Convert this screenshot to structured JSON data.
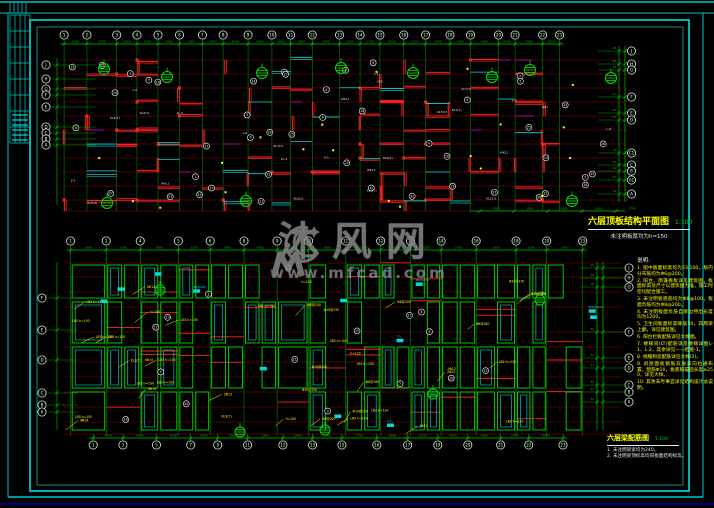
{
  "watermark": {
    "name": "沐风网",
    "url": "www.mfcad.com",
    "logo_icon": "crescent-m-logo",
    "color": "#8f8f8f"
  },
  "top_plan": {
    "title": "六层顶板结构平面图",
    "scale": "1:100",
    "subtitle": "未注明板厚均为h=150",
    "axes_top": [
      "1",
      "2",
      "3",
      "4",
      "5",
      "6",
      "7",
      "8",
      "9",
      "10",
      "11",
      "12",
      "13",
      "14",
      "15",
      "16",
      "17",
      "18",
      "19",
      "20",
      "21",
      "22",
      "23"
    ],
    "axes_left": [
      "J",
      "H",
      "G",
      "F",
      "E",
      "D",
      "C",
      "B",
      "A"
    ],
    "axes_right": [
      "J",
      "H",
      "G",
      "F",
      "E",
      "D",
      "C1",
      "C",
      "B",
      "A1",
      "A"
    ]
  },
  "bottom_plan": {
    "title": "六层梁配筋图",
    "scale": "1:100",
    "notes": [
      "1. 未注明梁宽均为240。",
      "2. 未注明梁顶标高均同板面结构标高。"
    ],
    "axes_top": [
      "1",
      "2",
      "4",
      "5",
      "6",
      "8",
      "9",
      "10",
      "11",
      "12",
      "13",
      "14",
      "16",
      "18",
      "20",
      "23"
    ],
    "axes_bottom": [
      "1",
      "3",
      "5",
      "7",
      "9",
      "11",
      "12",
      "13",
      "15",
      "16",
      "17",
      "19",
      "20",
      "21",
      "22",
      "23"
    ],
    "axes_left": [
      "F",
      "E",
      "D",
      "C",
      "B",
      "A"
    ],
    "axes_right": [
      "J",
      "H",
      "G",
      "F",
      "E",
      "D",
      "C",
      "B",
      "A"
    ]
  },
  "right_notes": {
    "heading": "说明:",
    "items": [
      "1. 图中板面标高均为23.100，板内分布筋均为Φ6@200。",
      "2. 阳台、雨篷挑板详见建筑图，板面标高及尺寸以建筑图为准，施工时密切配合施工。",
      "3. 未注明板底筋均为Φ8@100，板面负筋均为Φ8@200。",
      "4. 未注明板面负筋自梁边伸出长度均为1200。",
      "5. 卫生间板面标高降低50，四周梁上翻，详见建筑图。",
      "6. 阳台栏板配筋详见大样图。",
      "7. 楼梯间(LT)配筋详见楼梯详图L-1、L-2，其余详见——结施-1。",
      "8. 挑檐构造配筋详见大样(2)。",
      "9. 斜屋面板钢筋双层双向拉通布置，配筋Φ10，板底筋锚固长度≥250，详见大样。",
      "10. 其余未尽事宜详见结构设计总说明。"
    ]
  },
  "dims": {
    "pool": [
      "3300",
      "2700",
      "3000",
      "2100",
      "3900",
      "1500",
      "2400",
      "4200",
      "2900",
      "2000",
      "1800",
      "3600"
    ]
  },
  "labels": {
    "yellow": [
      "Φ8@200",
      "Φ8@150",
      "Φ10@200",
      "LB1 h=100",
      "LB2 h=120",
      "LB3 h=100",
      "Φ6@200",
      "2Φ12",
      "h=100",
      "h=120",
      "Φ8@100",
      "LB5 h=100",
      "Φ10@150",
      "4Φ14",
      "KL3(7)",
      "Φ8@180"
    ],
    "white": [
      "KL1(7)",
      "KL2(7)",
      "L-1",
      "L-2",
      "WKL1",
      "LL-3",
      "KL5(3)",
      "L-6",
      "KL7(7)",
      "GZ1",
      "Z-1",
      "KL9(1)"
    ],
    "cyan": [
      "Φ8@200",
      "C8@200",
      "Φ8@150",
      "Y-1",
      "Φ10@200"
    ]
  },
  "colors": {
    "border_cyan": "#00c8c8",
    "grid_red_dark": "#9c0000",
    "beam_red": "#ff2020",
    "axis_green": "#00a000",
    "bright_green": "#00e000",
    "dim_green": "#00c000",
    "wall_cyan": "#00dcdc",
    "note_yellow": "#ffff00",
    "magenta": "#cc00cc",
    "navy": "#0000a0",
    "white": "#ffffff"
  }
}
